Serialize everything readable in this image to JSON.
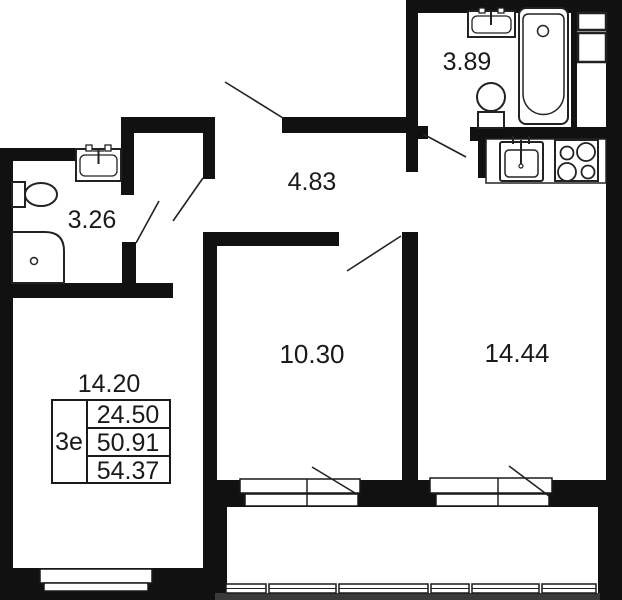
{
  "colors": {
    "walls": "#111111",
    "fixture_lines": "#222222",
    "background": "#ffffff",
    "ground_strip": "#3a3a3a"
  },
  "plan": {
    "rooms": [
      {
        "name": "bathroom-top",
        "area": "3.89"
      },
      {
        "name": "hallway",
        "area": "4.83"
      },
      {
        "name": "bathroom-left",
        "area": "3.26"
      },
      {
        "name": "room-small",
        "area": "10.30"
      },
      {
        "name": "kitchen-living",
        "area": "14.44"
      },
      {
        "name": "living-room",
        "area": "14.20"
      }
    ],
    "unit_stamp": {
      "type": "3е",
      "values": [
        "24.50",
        "50.91",
        "54.37"
      ]
    }
  }
}
